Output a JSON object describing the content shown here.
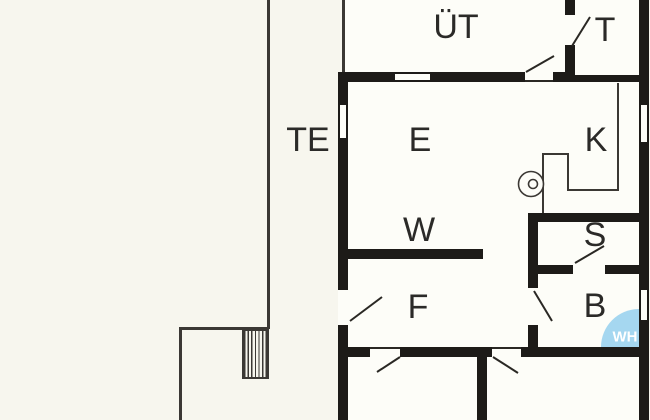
{
  "plan": {
    "title": "floor-plan",
    "rooms": {
      "ut": {
        "label": "ÜT"
      },
      "t": {
        "label": "T"
      },
      "te": {
        "label": "TE"
      },
      "e": {
        "label": "E"
      },
      "k": {
        "label": "K"
      },
      "w": {
        "label": "W"
      },
      "s": {
        "label": "S"
      },
      "f": {
        "label": "F"
      },
      "b": {
        "label": "B"
      },
      "wh": {
        "label": "WH"
      }
    },
    "colors": {
      "wall": "#1d1b18",
      "thin_line": "#3b3834",
      "room_fill": "#fdfdf8",
      "outside_fill": "#f7f6ee",
      "water_heater_blue": "#a5d7f0",
      "water_heater_text": "#ffffff"
    }
  }
}
